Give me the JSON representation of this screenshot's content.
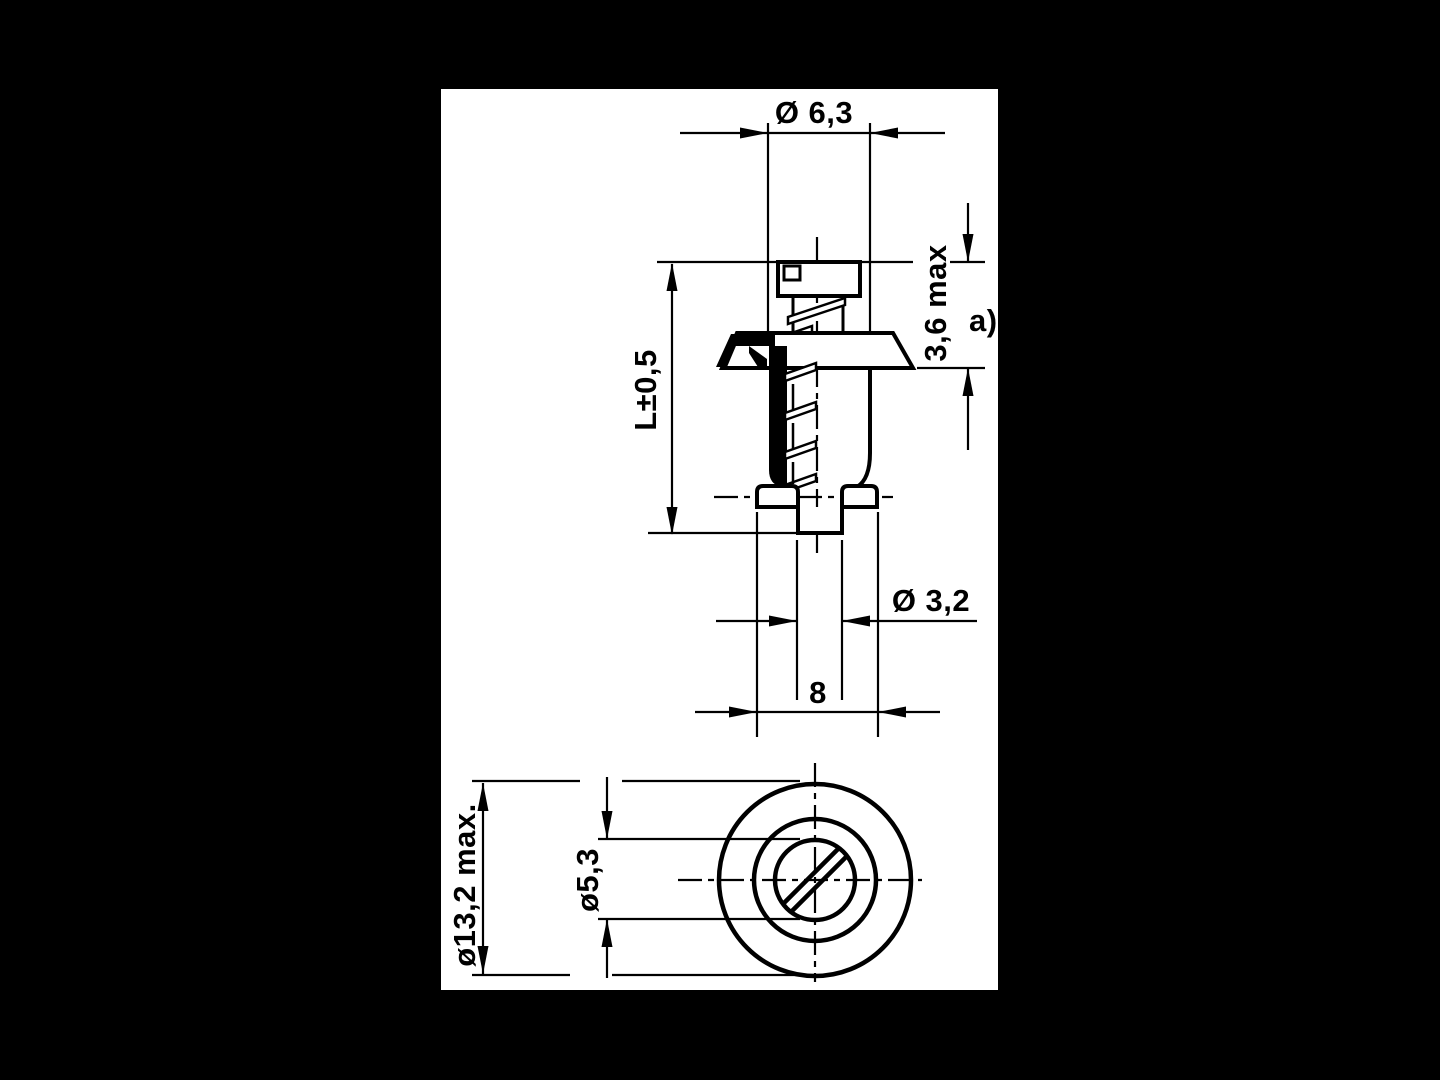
{
  "drawing": {
    "title": "fastener-grommet-technical-drawing",
    "colors": {
      "ink": "#000000",
      "paper": "#ffffff",
      "backdrop": "#000000"
    },
    "labels": {
      "head_diameter": "Ø 6,3",
      "protrusion_height": "3,6 max",
      "footnote": "a)",
      "length": "L±0,5",
      "screw_tip_diameter": "Ø 3,2",
      "foot_width": "8",
      "flange_diameter": "ø13,2 max.",
      "slot_circle_diameter": "ø5,3"
    }
  }
}
